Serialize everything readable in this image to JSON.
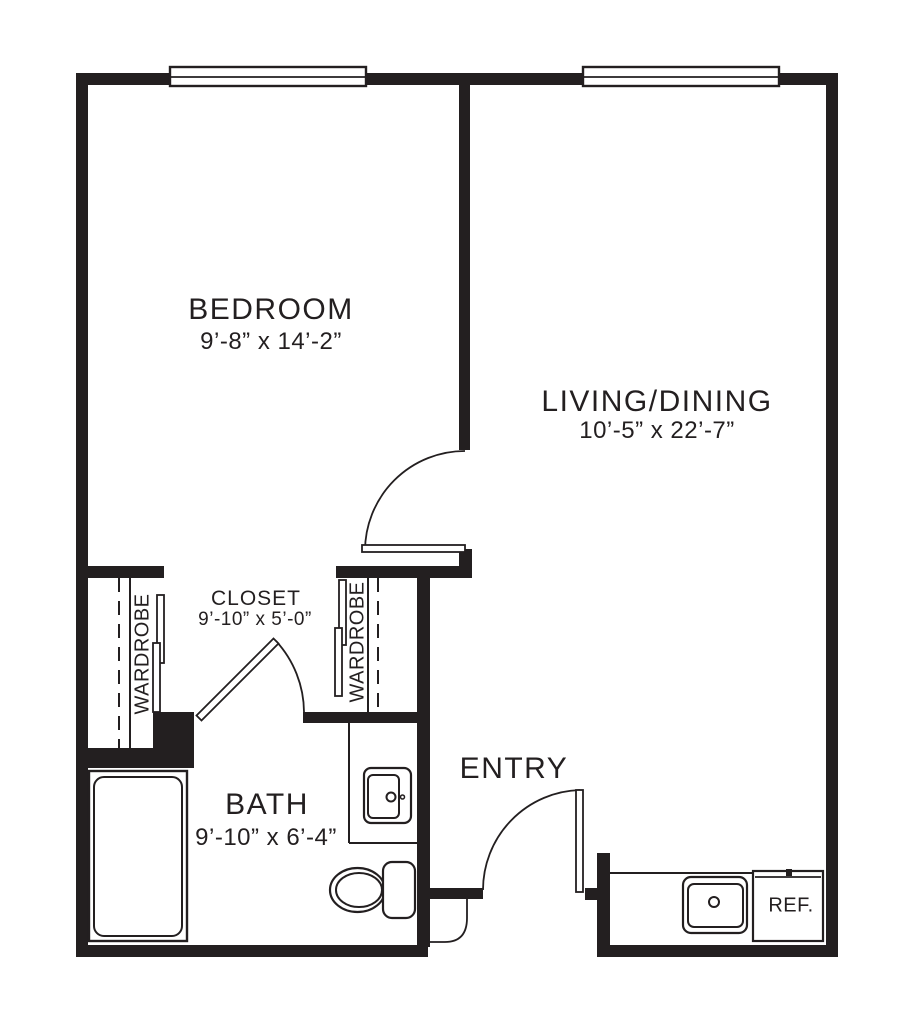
{
  "plan": {
    "background_color": "#ffffff",
    "line_color": "#231f20",
    "rooms": {
      "bedroom": {
        "name": "BEDROOM",
        "dimensions": "9’-8” x 14’-2”"
      },
      "living_dining": {
        "name": "LIVING/DINING",
        "dimensions": "10’-5” x 22’-7”"
      },
      "closet": {
        "name": "CLOSET",
        "dimensions": "9’-10” x 5’-0”"
      },
      "bath": {
        "name": "BATH",
        "dimensions": "9’-10” x 6’-4”"
      },
      "entry": {
        "name": "ENTRY"
      }
    },
    "fixtures": {
      "wardrobe_left_label": "WARDROBE",
      "wardrobe_right_label": "WARDROBE",
      "refrigerator_label": "REF."
    }
  }
}
